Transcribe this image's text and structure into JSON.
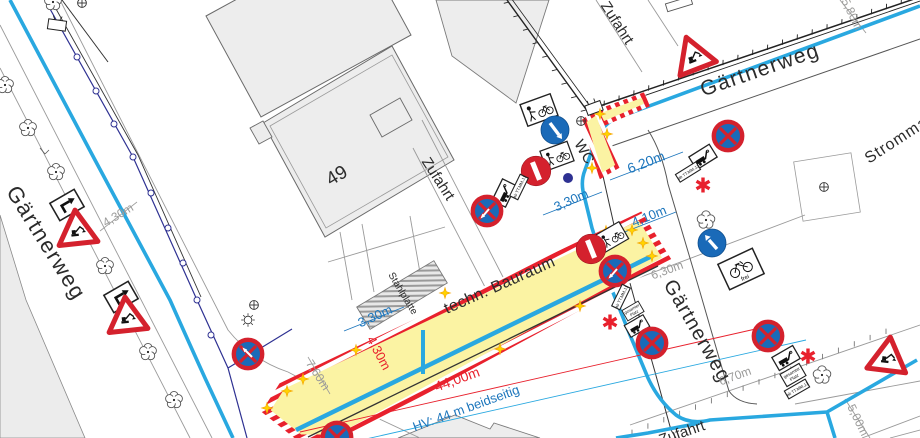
{
  "map": {
    "streets": {
      "gaertnerweg": "Gärtnerweg",
      "zufahrt": "Zufahrt",
      "strommast": "Strommast"
    },
    "labels": {
      "building_number": "49",
      "wc": "WC",
      "stahlplatte": "Stahlplatte",
      "bauraum": "techn. Bauraum"
    },
    "dims": {
      "d620": "6,20m",
      "d330": "3,30m",
      "d410": "4,10m",
      "d430": "4,30m",
      "d4400": "44,00m",
      "hv": "HV: 44 m beidseitig",
      "d760": "7,60m",
      "d630": "6,30m",
      "d670": "6,70m",
      "d500": "5,00m",
      "d580": "5,80m"
    },
    "signs": {
      "frei": "frei",
      "ab_date": "ab TT.MM.JJ",
      "platz1": "gesamter",
      "platz2": "Platz"
    },
    "colors": {
      "water_line": "#29a8e0",
      "utility_line": "#2e3192",
      "sign_red": "#d4212d",
      "sign_blue": "#1a6ab8",
      "zone_yellow": "#fbf3a3",
      "dim_blue": "#1b75bc",
      "dim_red": "#e8212d",
      "dim_gray": "#9b9b9a"
    }
  }
}
